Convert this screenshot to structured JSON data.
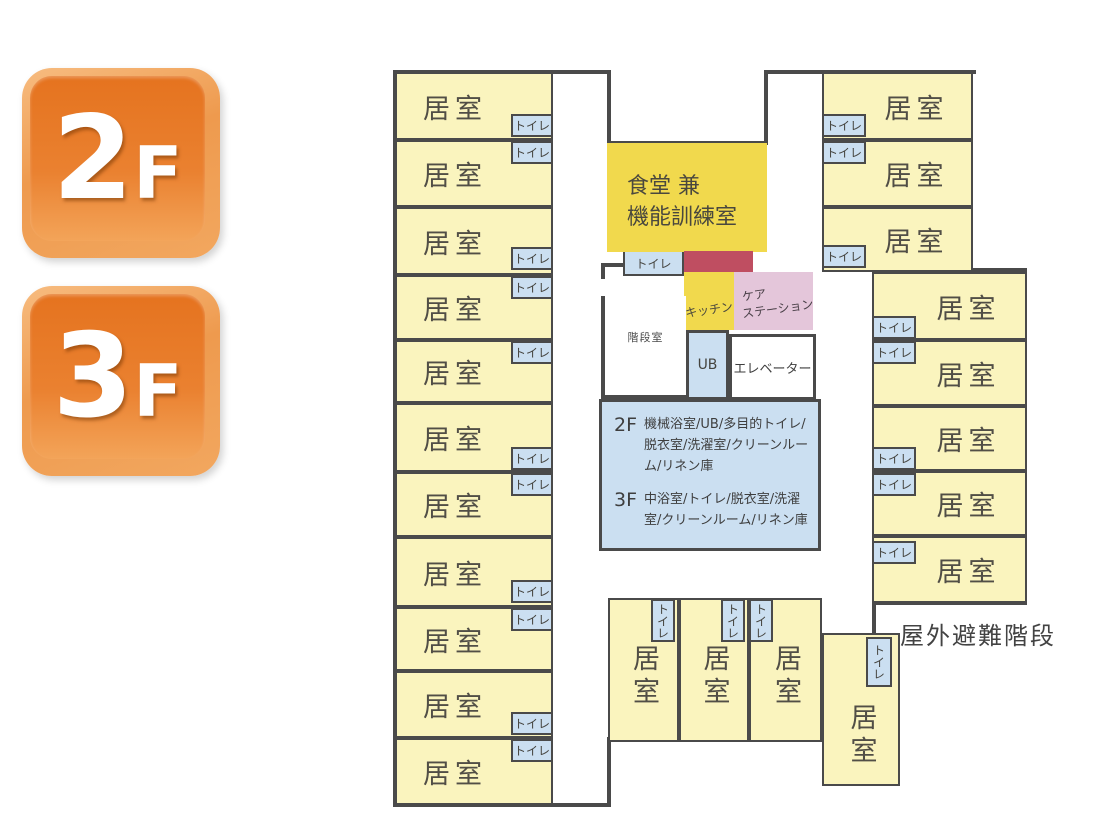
{
  "badges": [
    {
      "number": "2",
      "suffix": "F"
    },
    {
      "number": "3",
      "suffix": "F"
    }
  ],
  "colors": {
    "room_fill": "#FAF4BE",
    "toilet_fill": "#CBDFF1",
    "dining_fill": "#F1D94D",
    "kitchen_fill": "#F1D94D",
    "care_fill": "#E4C6DA",
    "red_zone_fill": "#BF4E61",
    "info_fill": "#CBDFF1",
    "wall": "#4A4A4A",
    "badge_orange": "#EA8130",
    "room_label_text": "#514E46"
  },
  "info_box": {
    "f2_label": "2F",
    "f2_text": "機械浴室/UB/多目的トイレ/脱衣室/洗濯室/クリーンルーム/リネン庫",
    "f3_label": "3F",
    "f3_text": "中浴室/トイレ/脱衣室/洗濯室/クリーンルーム/リネン庫"
  },
  "plan": {
    "special": {
      "dining": {
        "lines": [
          "食堂 兼",
          "機能訓練室"
        ]
      },
      "kitchen": {
        "label": "キッチン"
      },
      "care": {
        "lines": [
          "ケア",
          "ステーション"
        ]
      },
      "stair": {
        "label": "階段室"
      },
      "ub": {
        "label": "UB"
      },
      "elevator": {
        "label": "エレベーター"
      },
      "outdoor": {
        "label": "屋外避難階段"
      }
    },
    "rooms": [
      {
        "x": 395,
        "y": 72,
        "w": 158,
        "h": 68,
        "label": "居室",
        "a": "l"
      },
      {
        "x": 395,
        "y": 140,
        "w": 158,
        "h": 67,
        "label": "居室",
        "a": "l"
      },
      {
        "x": 395,
        "y": 207,
        "w": 158,
        "h": 68,
        "label": "居室",
        "a": "l"
      },
      {
        "x": 395,
        "y": 275,
        "w": 158,
        "h": 65,
        "label": "居室",
        "a": "l"
      },
      {
        "x": 395,
        "y": 340,
        "w": 158,
        "h": 63,
        "label": "居室",
        "a": "l"
      },
      {
        "x": 395,
        "y": 403,
        "w": 158,
        "h": 69,
        "label": "居室",
        "a": "l"
      },
      {
        "x": 395,
        "y": 472,
        "w": 158,
        "h": 65,
        "label": "居室",
        "a": "l"
      },
      {
        "x": 395,
        "y": 537,
        "w": 158,
        "h": 70,
        "label": "居室",
        "a": "l"
      },
      {
        "x": 395,
        "y": 607,
        "w": 158,
        "h": 64,
        "label": "居室",
        "a": "l"
      },
      {
        "x": 395,
        "y": 671,
        "w": 158,
        "h": 67,
        "label": "居室",
        "a": "l"
      },
      {
        "x": 395,
        "y": 738,
        "w": 158,
        "h": 67,
        "label": "居室",
        "a": "l"
      },
      {
        "x": 822,
        "y": 72,
        "w": 151,
        "h": 68,
        "label": "居室",
        "a": "r"
      },
      {
        "x": 822,
        "y": 140,
        "w": 151,
        "h": 67,
        "label": "居室",
        "a": "r"
      },
      {
        "x": 822,
        "y": 207,
        "w": 151,
        "h": 65,
        "label": "居室",
        "a": "r"
      },
      {
        "x": 872,
        "y": 272,
        "w": 155,
        "h": 68,
        "label": "居室",
        "a": "r"
      },
      {
        "x": 872,
        "y": 340,
        "w": 155,
        "h": 66,
        "label": "居室",
        "a": "r"
      },
      {
        "x": 872,
        "y": 406,
        "w": 155,
        "h": 65,
        "label": "居室",
        "a": "r"
      },
      {
        "x": 872,
        "y": 471,
        "w": 155,
        "h": 65,
        "label": "居室",
        "a": "r"
      },
      {
        "x": 872,
        "y": 536,
        "w": 155,
        "h": 67,
        "label": "居室",
        "a": "r"
      },
      {
        "x": 608,
        "y": 598,
        "w": 71,
        "h": 144,
        "label": "居室",
        "v": true,
        "lt": 44
      },
      {
        "x": 679,
        "y": 598,
        "w": 70,
        "h": 144,
        "label": "居室",
        "v": true,
        "lt": 44
      },
      {
        "x": 749,
        "y": 598,
        "w": 73,
        "h": 144,
        "label": "居室",
        "v": true,
        "lt": 44
      },
      {
        "x": 822,
        "y": 633,
        "w": 78,
        "h": 153,
        "label": "居室",
        "v": true,
        "lt": 68
      }
    ],
    "toilets": [
      {
        "x": 511,
        "y": 114,
        "w": 42,
        "h": 23,
        "label": "トイレ"
      },
      {
        "x": 511,
        "y": 141,
        "w": 42,
        "h": 23,
        "label": "トイレ"
      },
      {
        "x": 511,
        "y": 247,
        "w": 42,
        "h": 23,
        "label": "トイレ"
      },
      {
        "x": 511,
        "y": 276,
        "w": 42,
        "h": 23,
        "label": "トイレ"
      },
      {
        "x": 511,
        "y": 341,
        "w": 42,
        "h": 23,
        "label": "トイレ"
      },
      {
        "x": 511,
        "y": 447,
        "w": 42,
        "h": 23,
        "label": "トイレ"
      },
      {
        "x": 511,
        "y": 473,
        "w": 42,
        "h": 23,
        "label": "トイレ"
      },
      {
        "x": 511,
        "y": 580,
        "w": 42,
        "h": 23,
        "label": "トイレ"
      },
      {
        "x": 511,
        "y": 608,
        "w": 42,
        "h": 23,
        "label": "トイレ"
      },
      {
        "x": 511,
        "y": 712,
        "w": 42,
        "h": 23,
        "label": "トイレ"
      },
      {
        "x": 511,
        "y": 739,
        "w": 42,
        "h": 23,
        "label": "トイレ"
      },
      {
        "x": 822,
        "y": 114,
        "w": 44,
        "h": 23,
        "label": "トイレ"
      },
      {
        "x": 822,
        "y": 141,
        "w": 44,
        "h": 23,
        "label": "トイレ"
      },
      {
        "x": 822,
        "y": 245,
        "w": 44,
        "h": 23,
        "label": "トイレ"
      },
      {
        "x": 872,
        "y": 316,
        "w": 44,
        "h": 23,
        "label": "トイレ"
      },
      {
        "x": 872,
        "y": 341,
        "w": 44,
        "h": 23,
        "label": "トイレ"
      },
      {
        "x": 872,
        "y": 447,
        "w": 44,
        "h": 23,
        "label": "トイレ"
      },
      {
        "x": 872,
        "y": 473,
        "w": 44,
        "h": 23,
        "label": "トイレ"
      },
      {
        "x": 872,
        "y": 541,
        "w": 44,
        "h": 23,
        "label": "トイレ"
      },
      {
        "x": 623,
        "y": 250,
        "w": 61,
        "h": 26,
        "label": "トイレ"
      },
      {
        "x": 651,
        "y": 599,
        "w": 24,
        "h": 43,
        "label": "トイレ",
        "v": true
      },
      {
        "x": 721,
        "y": 599,
        "w": 24,
        "h": 43,
        "label": "トイレ",
        "v": true
      },
      {
        "x": 749,
        "y": 599,
        "w": 24,
        "h": 43,
        "label": "トイレ",
        "v": true
      },
      {
        "x": 866,
        "y": 637,
        "w": 26,
        "h": 50,
        "label": "トイレ",
        "v": true
      }
    ],
    "walls": [
      [
        393,
        70,
        218,
        4
      ],
      [
        607,
        70,
        4,
        75
      ],
      [
        607,
        141,
        161,
        4
      ],
      [
        764,
        70,
        4,
        75
      ],
      [
        764,
        70,
        212,
        4
      ],
      [
        393,
        70,
        4,
        737
      ],
      [
        393,
        803,
        218,
        4
      ],
      [
        607,
        737,
        4,
        70
      ],
      [
        969,
        70,
        4,
        202
      ],
      [
        969,
        268,
        58,
        4
      ],
      [
        1023,
        268,
        4,
        337
      ],
      [
        872,
        601,
        155,
        4
      ],
      [
        872,
        601,
        4,
        36
      ],
      [
        818,
        633,
        10,
        4
      ],
      [
        601,
        263,
        26,
        4
      ],
      [
        601,
        263,
        4,
        16
      ]
    ]
  }
}
